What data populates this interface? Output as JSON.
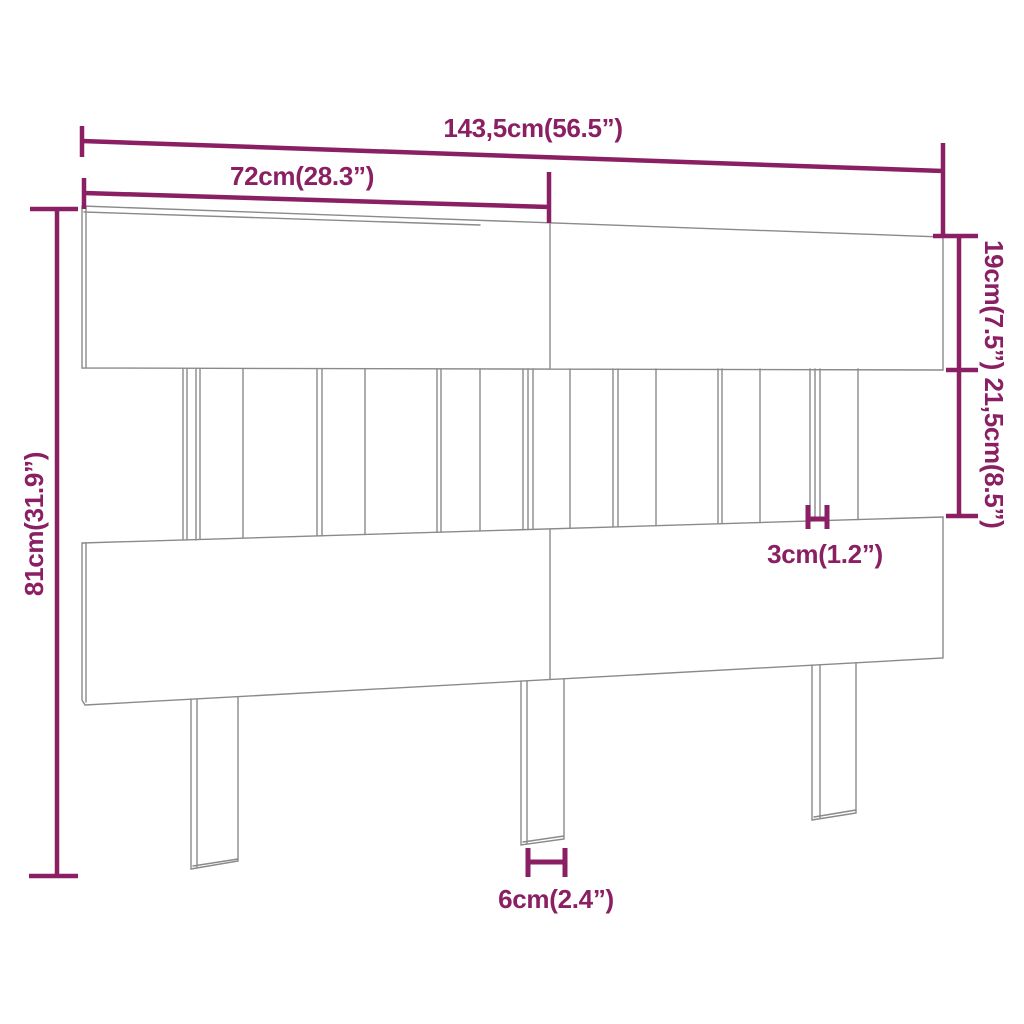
{
  "diagram": {
    "subject": "headboard-dimension-drawing",
    "accent_color": "#8a2063",
    "line_color": "#8a8a8a",
    "background_color": "#ffffff",
    "labels": {
      "total_width": "143,5cm(56.5”)",
      "upper_board_width": "72cm(28.3”)",
      "top_board_height": "19cm(7.5”)",
      "slat_section_height": "21,5cm(8.5”)",
      "total_height": "81cm(31.9”)",
      "slat_width": "3cm(1.2”)",
      "leg_width": "6cm(2.4”)"
    }
  }
}
